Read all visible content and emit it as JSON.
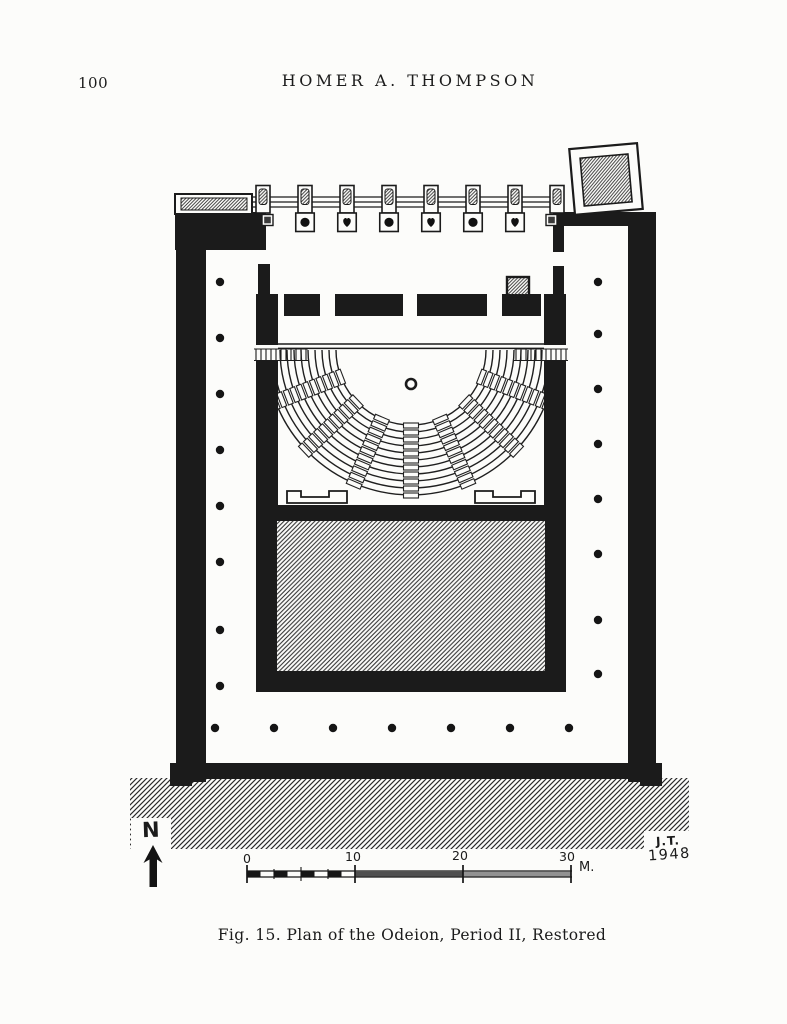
{
  "page": {
    "number": "100",
    "header": "HOMER A. THOMPSON",
    "caption": "Fig. 15.  Plan of the Odeion, Period II, Restored"
  },
  "figure": {
    "north_label": "N",
    "signature_line1": "J.T.",
    "signature_line2": "1948",
    "scale_bar": {
      "tick_0": "0",
      "tick_10": "10",
      "tick_20": "20",
      "tick_30": "30",
      "unit": "M."
    }
  },
  "colors": {
    "ink": "#1b1b1b",
    "paper": "#fcfcfa",
    "hatch": "#2e2e2e",
    "scale_band_dark": "#4f4f4f",
    "scale_band_light": "#929292"
  }
}
